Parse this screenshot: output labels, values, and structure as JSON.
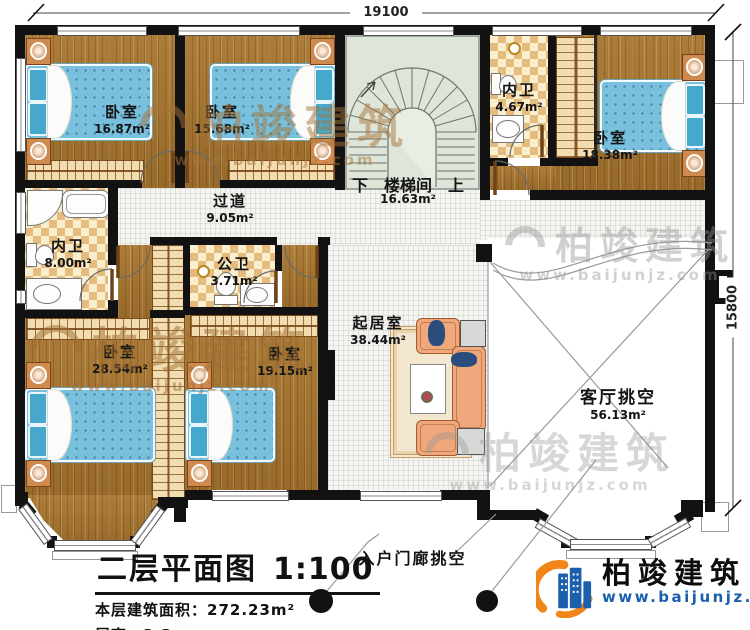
{
  "plan": {
    "dim_top": "19100",
    "dim_right": "15800",
    "rooms": {
      "bedroom_tl": {
        "name": "卧室",
        "area": "16.87m²"
      },
      "bedroom_tm": {
        "name": "卧室",
        "area": "15.68m²"
      },
      "bedroom_tr": {
        "name": "卧室",
        "area": "18.38m²"
      },
      "bedroom_bl": {
        "name": "卧室",
        "area": "28.54m²"
      },
      "bedroom_bm": {
        "name": "卧室",
        "area": "19.15m²"
      },
      "stair": {
        "down": "下",
        "name": "楼梯间",
        "up": "上",
        "area": "16.63m²"
      },
      "bath_ensuite_tr": {
        "name": "内卫",
        "area": "4.67m²"
      },
      "bath_ensuite_left": {
        "name": "内卫",
        "area": "8.00m²"
      },
      "bath_public": {
        "name": "公卫",
        "area": "3.71m²"
      },
      "corridor": {
        "name": "过道",
        "area": "9.05m²"
      },
      "living": {
        "name": "起居室",
        "area": "38.44m²"
      },
      "living_void": {
        "name": "客厅挑空",
        "area": "56.13m²"
      },
      "porch_void": {
        "name": "入户门廊挑空"
      }
    }
  },
  "title_block": {
    "title": "二层平面图",
    "scale": "1:100",
    "floor_area_label": "本层建筑面积：",
    "floor_area": "272.23m²",
    "floor_height_label": "层高：",
    "floor_height": "3.3m"
  },
  "brand": {
    "name": "柏竣建筑",
    "site": "www.baijunjz.com"
  },
  "watermark": {
    "name": "柏竣建筑",
    "site": "www.baijunjz.com"
  },
  "colors": {
    "wall": "#121212",
    "wood": "#a8762f",
    "tile": "#f4f4f1",
    "checker": "#e5bc7e",
    "stair": "#dee5d9",
    "bed": "#79c0dc",
    "sofa": "#efa77b",
    "logo_blue": "#1c5fad",
    "logo_orange": "#f08519"
  }
}
